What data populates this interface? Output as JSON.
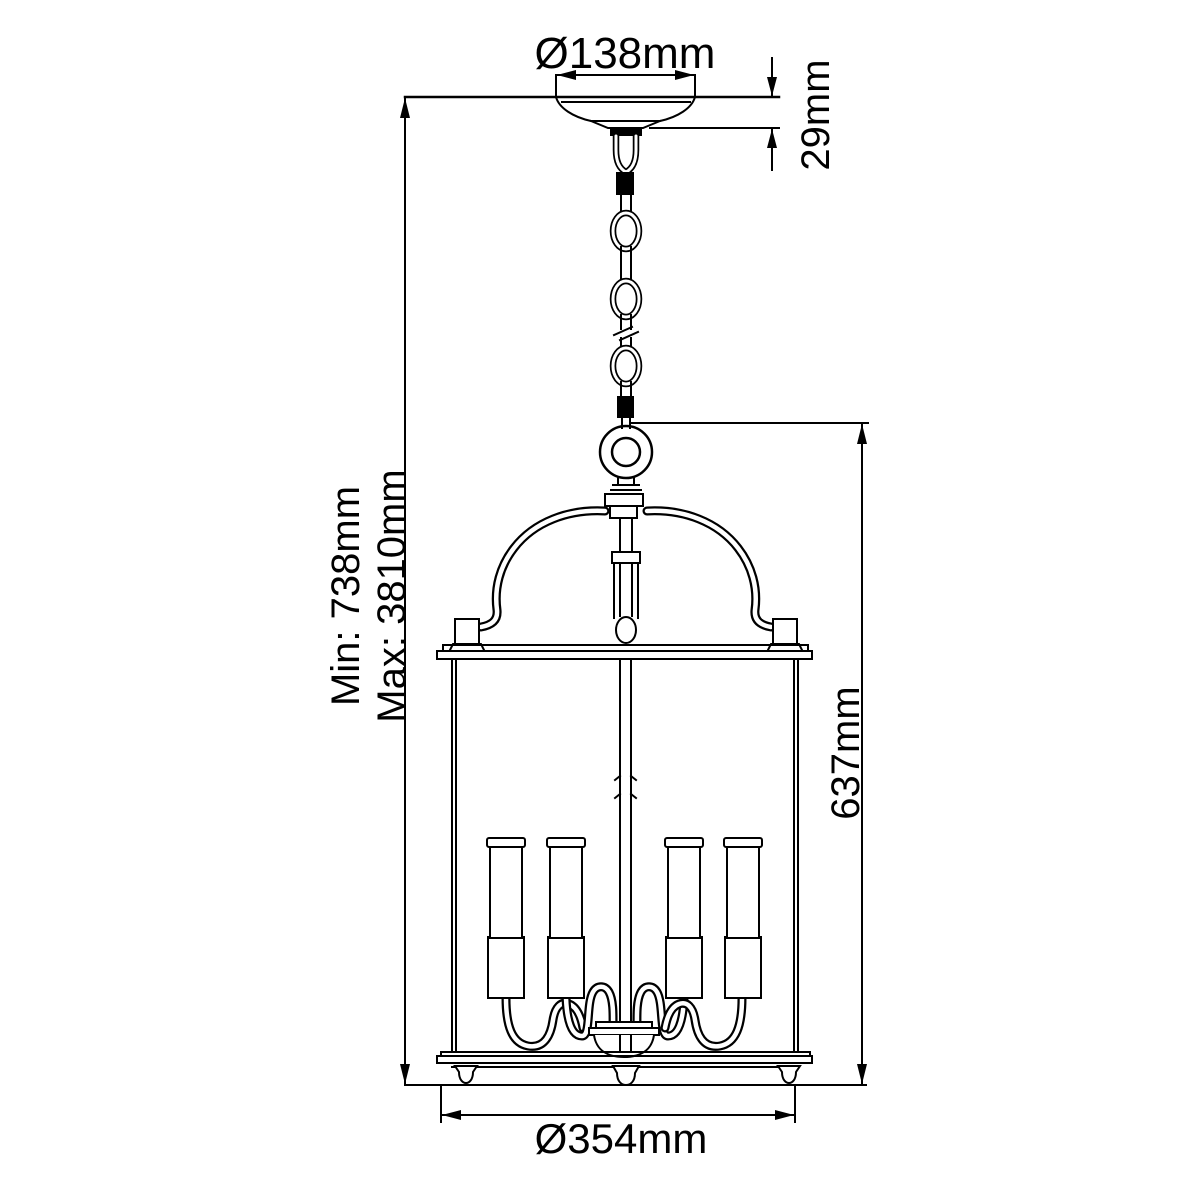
{
  "title": "Hanging lantern pendant dimension diagram",
  "colors": {
    "line": "#000000",
    "background": "#ffffff",
    "text": "#000000"
  },
  "labels": {
    "canopy_diameter": "Ø138mm",
    "canopy_height": "29mm",
    "min_drop": "Min: 738mm",
    "max_drop": "Max: 3810mm",
    "lantern_height": "637mm",
    "lantern_diameter": "Ø354mm"
  },
  "fixture": {
    "type": "chain-hung lantern pendant",
    "visible_candles": 4
  }
}
